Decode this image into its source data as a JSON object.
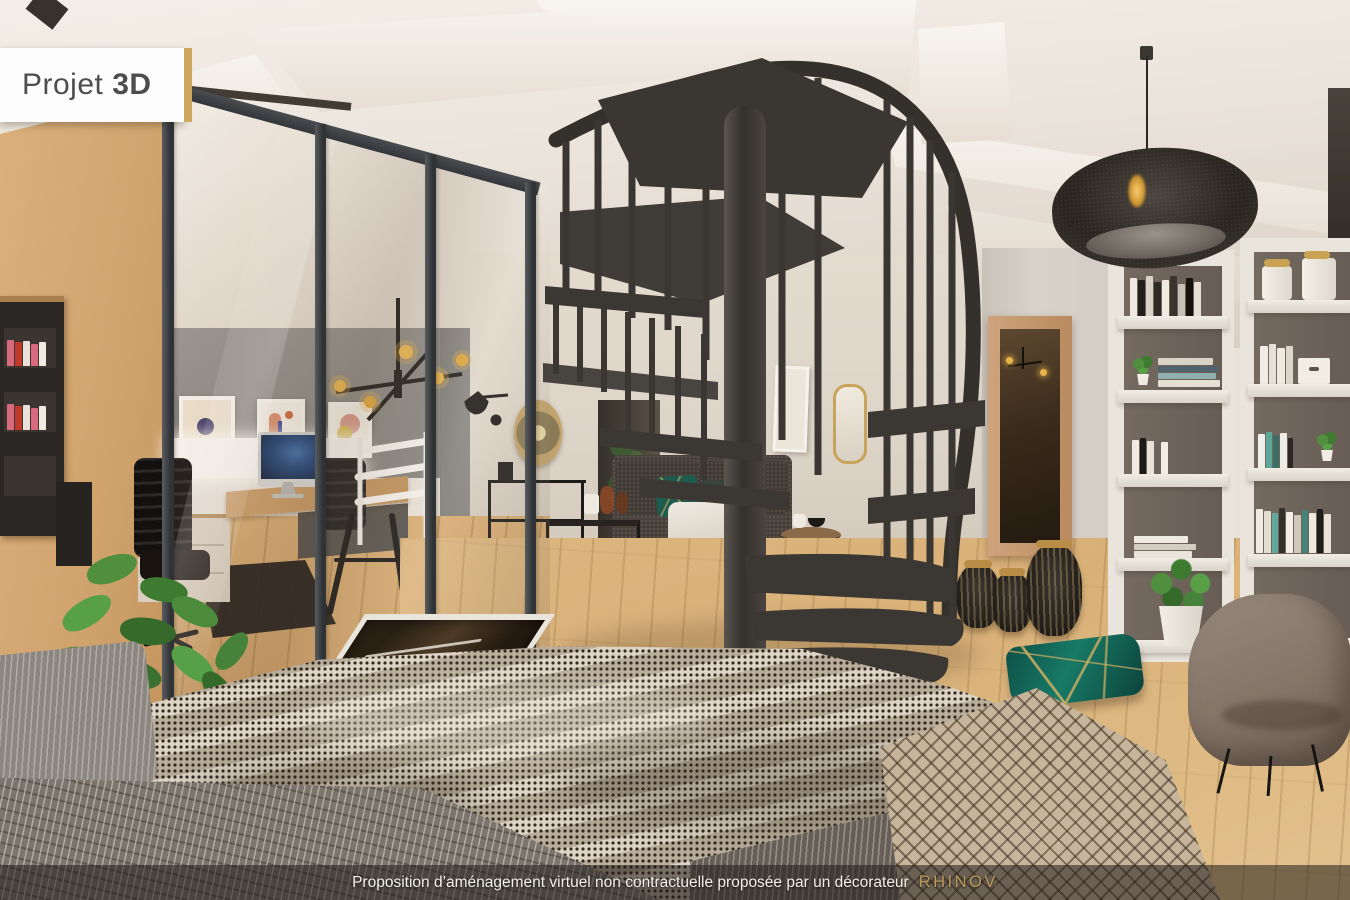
{
  "badge": {
    "text_regular": "Projet",
    "text_bold": "3D",
    "bg": "#FDFDFD",
    "text_color": "#4D4D4D",
    "edge_color": "#CFA761"
  },
  "footer": {
    "text": "Proposition d’aménagement virtuel non contractuelle proposée par un décorateur",
    "brand": "RHINOV",
    "bg": "rgba(33,28,23,0.55)",
    "text_color": "#F3F0EA",
    "brand_color": "#BB9A5E"
  },
  "palette": {
    "ceiling": "#EFE9E0",
    "wall_tan": "#CFA36E",
    "office_wall": "#8E8C87",
    "living_wall": "#DED6CA",
    "wood_floor": "#D9B178",
    "partition_frame": "#3E4144",
    "staircase": "#3B3835",
    "sofa": "#48413B",
    "rug": "#B4ADA4",
    "pouf": "#CF8C2E",
    "teal_pillow": "#14635B",
    "armchair": "#8D7F74",
    "shelf_back": "#6B6159",
    "mirror_wood": "#C3966B",
    "plant": "#4C8B3C",
    "duvet": "#CFC3B1",
    "throw": "#7B756D",
    "accent_gold": "#C9A254",
    "pendant": "#2D2823"
  },
  "scene": {
    "label": "3D render of a loft interior with mezzanine office, spiral staircase and bedroom",
    "objects": [
      "ceiling-beams",
      "glass-partition",
      "home-office",
      "desk",
      "imac",
      "office-chairs",
      "wall-posters",
      "chandelier",
      "mezzanine-railing",
      "spiral-staircase",
      "pendant-lamp",
      "sofa",
      "rug",
      "nesting-tables",
      "console-table",
      "wall-sconce",
      "rattan-mirror",
      "pouf",
      "side-table",
      "door-opening",
      "standing-mirror",
      "floor-vases",
      "bookshelves",
      "floor-plants",
      "armchair",
      "floor-cushion",
      "floor-hatch",
      "bed",
      "throws"
    ]
  },
  "bookshelf": {
    "left_shelf1": [
      {
        "c": "#efeae1",
        "h": 42
      },
      {
        "c": "#211e1b",
        "h": 40
      },
      {
        "c": "#d9d3c9",
        "h": 44
      },
      {
        "c": "#2e2a26",
        "h": 38
      },
      {
        "c": "#f1ece3",
        "h": 40
      },
      {
        "c": "#39342f",
        "h": 44
      },
      {
        "c": "#c7c0b5",
        "h": 36
      },
      {
        "c": "#16130f",
        "h": 42
      },
      {
        "c": "#e6e0d6",
        "h": 38
      }
    ],
    "left_shelf2_stack": [
      {
        "c": "#e4ded3",
        "h": 7,
        "w": 62
      },
      {
        "c": "#8fb0ae",
        "h": 6,
        "w": 58
      },
      {
        "c": "#50636e",
        "h": 6,
        "w": 60
      },
      {
        "c": "#d8d2c7",
        "h": 7,
        "w": 55
      }
    ],
    "left_shelf3": [
      {
        "c": "#f0ebe2",
        "h": 34
      },
      {
        "c": "#1d1a17",
        "h": 36,
        "w": 6
      },
      {
        "c": "#e8e2d8",
        "h": 33
      },
      {
        "c": "#6b655e",
        "h": 30,
        "w": 5
      },
      {
        "c": "#f3eee5",
        "h": 32
      }
    ],
    "left_shelf4_stack": [
      {
        "c": "#eae4da",
        "h": 7,
        "w": 58
      },
      {
        "c": "#d2ccc1",
        "h": 6,
        "w": 62
      },
      {
        "c": "#f0ebe1",
        "h": 7,
        "w": 54
      }
    ],
    "right_shelf2": [
      {
        "c": "#f2ede4",
        "h": 38,
        "w": 8
      },
      {
        "c": "#e6e0d6",
        "h": 40
      },
      {
        "c": "#efe9df",
        "h": 36,
        "w": 8
      },
      {
        "c": "#dcd6cb",
        "h": 38
      }
    ],
    "right_shelf3": [
      {
        "c": "#eff0ea",
        "h": 34
      },
      {
        "c": "#5fa79b",
        "h": 36,
        "w": 6
      },
      {
        "c": "#3a6f68",
        "h": 33,
        "w": 6
      },
      {
        "c": "#f1ece3",
        "h": 35
      },
      {
        "c": "#2b2723",
        "h": 30,
        "w": 5
      }
    ],
    "right_shelf4": [
      {
        "c": "#f0ebe2",
        "h": 44
      },
      {
        "c": "#e3ddd2",
        "h": 42
      },
      {
        "c": "#63a89c",
        "h": 40,
        "w": 6
      },
      {
        "c": "#34302b",
        "h": 45,
        "w": 6
      },
      {
        "c": "#f4efe6",
        "h": 41
      },
      {
        "c": "#cfc8bd",
        "h": 38
      },
      {
        "c": "#478278",
        "h": 43,
        "w": 6
      },
      {
        "c": "#efe9e0",
        "h": 40
      },
      {
        "c": "#1f1c19",
        "h": 44,
        "w": 6
      },
      {
        "c": "#e8e2d8",
        "h": 39
      }
    ],
    "wall_unit_spines": [
      {
        "c": "#d96a7e",
        "h": 26
      },
      {
        "c": "#c0392b",
        "h": 24
      },
      {
        "c": "#e8e2d8",
        "h": 25
      },
      {
        "c": "#d96a7e",
        "h": 22
      },
      {
        "c": "#f0ebe2",
        "h": 24
      }
    ]
  }
}
